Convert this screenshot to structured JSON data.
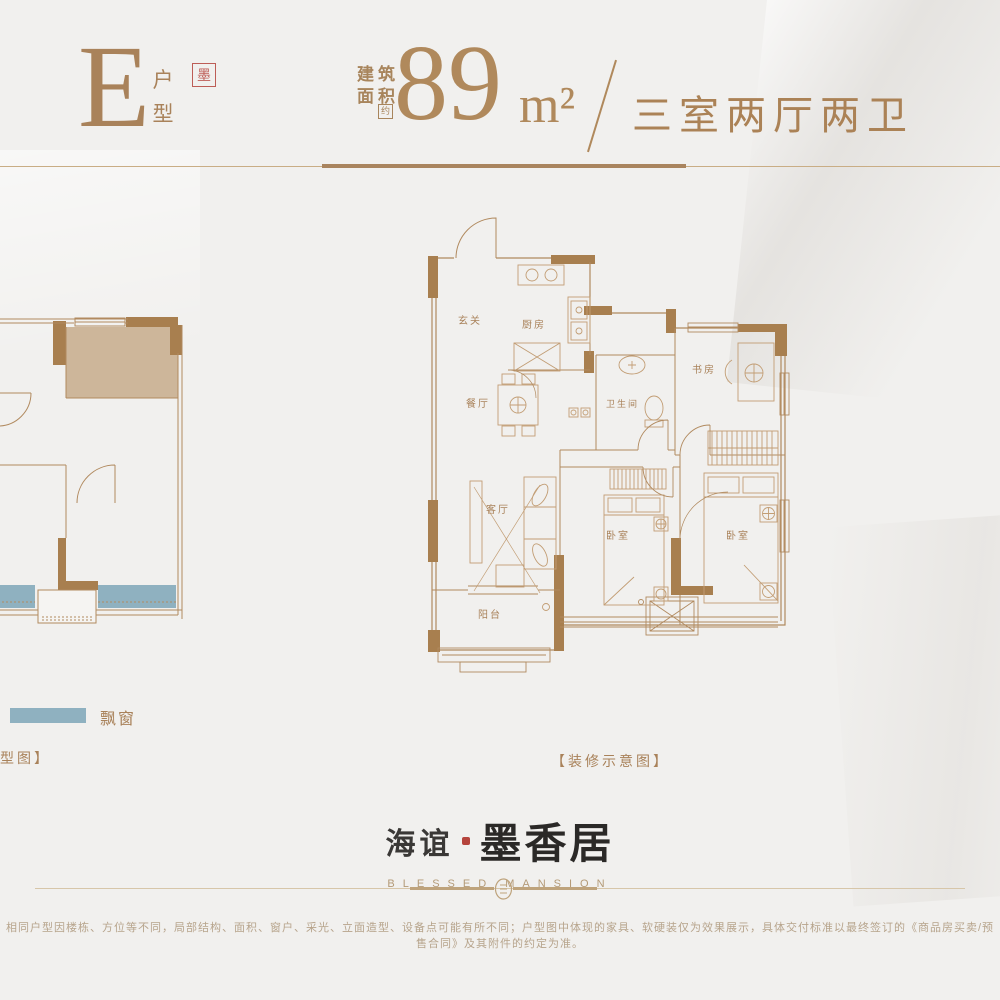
{
  "header": {
    "unit_letter": "E",
    "unit_type": "户型",
    "seal_char": "墨",
    "area_prefix_line1": "建筑",
    "area_prefix_line2": "面积",
    "approx_badge": "约",
    "area_value": "89",
    "area_unit": "m²",
    "layout_desc": "三室两厅两卫"
  },
  "floorplan": {
    "rooms": {
      "entry": "玄关",
      "kitchen": "厨房",
      "dining": "餐厅",
      "bathroom": "卫生间",
      "study": "书房",
      "living": "客厅",
      "bedroom1": "卧室",
      "bedroom2": "卧室",
      "balcony": "阳台"
    }
  },
  "legend": {
    "bay_window_label": "飘窗",
    "bay_window_color": "#8fb1c0"
  },
  "captions": {
    "left_partial": "型图】",
    "main": "【装修示意图】"
  },
  "logo": {
    "brand_left": "海谊",
    "brand_right": "墨香居",
    "brand_en": "BLESSED MANSION"
  },
  "disclaimer": "相同户型因楼栋、方位等不同，局部结构、面积、窗户、采光、立面造型、设备点可能有所不同；户型图中体现的家具、软硬装仅为效果展示，具体交付标准以最终签订的《商品房买卖/预售合同》及其附件的约定为准。",
  "colors": {
    "accent": "#ab8256",
    "wall": "#a87f4f",
    "line": "#b18a5f",
    "bay_window": "#8fb1c0",
    "highlight_room": "#cdb69a",
    "seal_red": "#b5443c",
    "background": "#f1f0ee"
  }
}
